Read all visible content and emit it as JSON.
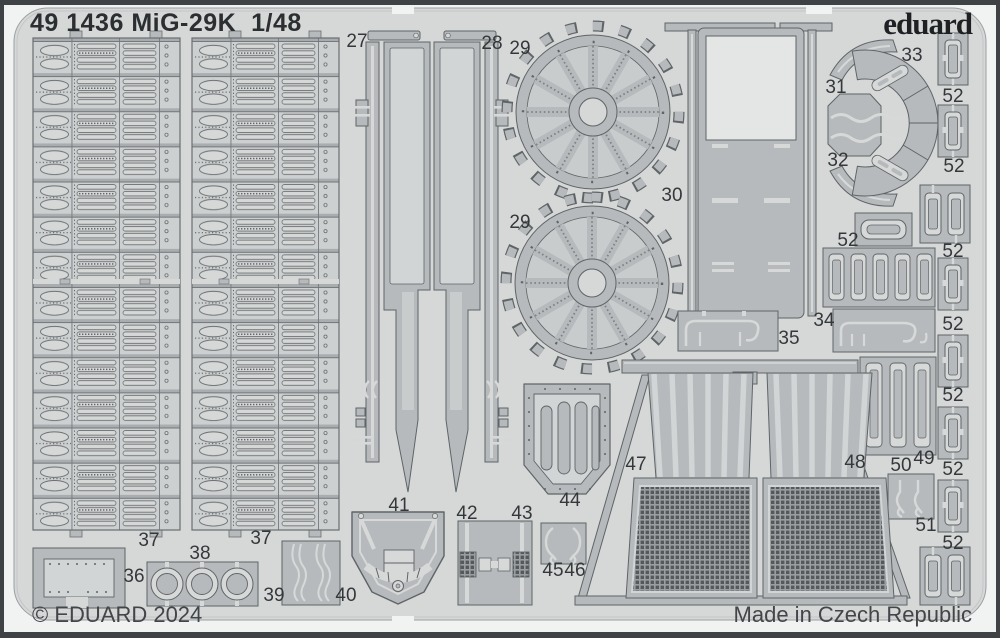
{
  "sheet": {
    "title": "49 1436 MiG-29K  1/48",
    "brand": "eduard",
    "copyright": "© EDUARD 2024",
    "made_in": "Made in Czech Republic"
  },
  "part_labels": [
    {
      "text": "27",
      "x": 357,
      "y": 42
    },
    {
      "text": "28",
      "x": 492,
      "y": 44
    },
    {
      "text": "29",
      "x": 520,
      "y": 49
    },
    {
      "text": "29",
      "x": 520,
      "y": 223
    },
    {
      "text": "30",
      "x": 672,
      "y": 196
    },
    {
      "text": "31",
      "x": 836,
      "y": 88
    },
    {
      "text": "32",
      "x": 838,
      "y": 161
    },
    {
      "text": "33",
      "x": 912,
      "y": 56
    },
    {
      "text": "34",
      "x": 824,
      "y": 321
    },
    {
      "text": "35",
      "x": 789,
      "y": 339
    },
    {
      "text": "36",
      "x": 134,
      "y": 577
    },
    {
      "text": "37",
      "x": 149,
      "y": 541
    },
    {
      "text": "37",
      "x": 261,
      "y": 539
    },
    {
      "text": "38",
      "x": 200,
      "y": 554
    },
    {
      "text": "39",
      "x": 274,
      "y": 596
    },
    {
      "text": "40",
      "x": 346,
      "y": 596
    },
    {
      "text": "41",
      "x": 399,
      "y": 506
    },
    {
      "text": "42",
      "x": 467,
      "y": 514
    },
    {
      "text": "43",
      "x": 522,
      "y": 514
    },
    {
      "text": "44",
      "x": 570,
      "y": 501
    },
    {
      "text": "45",
      "x": 553,
      "y": 571
    },
    {
      "text": "46",
      "x": 575,
      "y": 571
    },
    {
      "text": "47",
      "x": 636,
      "y": 465
    },
    {
      "text": "48",
      "x": 855,
      "y": 463
    },
    {
      "text": "49",
      "x": 924,
      "y": 459
    },
    {
      "text": "50",
      "x": 901,
      "y": 466
    },
    {
      "text": "51",
      "x": 926,
      "y": 526
    },
    {
      "text": "52",
      "x": 848,
      "y": 241
    },
    {
      "text": "52",
      "x": 953,
      "y": 97
    },
    {
      "text": "52",
      "x": 954,
      "y": 167
    },
    {
      "text": "52",
      "x": 953,
      "y": 252
    },
    {
      "text": "52",
      "x": 953,
      "y": 325
    },
    {
      "text": "52",
      "x": 953,
      "y": 396
    },
    {
      "text": "52",
      "x": 953,
      "y": 470
    },
    {
      "text": "52",
      "x": 953,
      "y": 544
    }
  ],
  "colors": {
    "frame_border": "#3f4244",
    "page_margin": "#f1f2f2",
    "sheet": "#d6d8d8",
    "part_metal": "#b6babc",
    "etch_outline": "#5f6466",
    "detail_light": "#d7d9d9",
    "mesh_dark": "#55595b",
    "label_text": "#35383b"
  }
}
